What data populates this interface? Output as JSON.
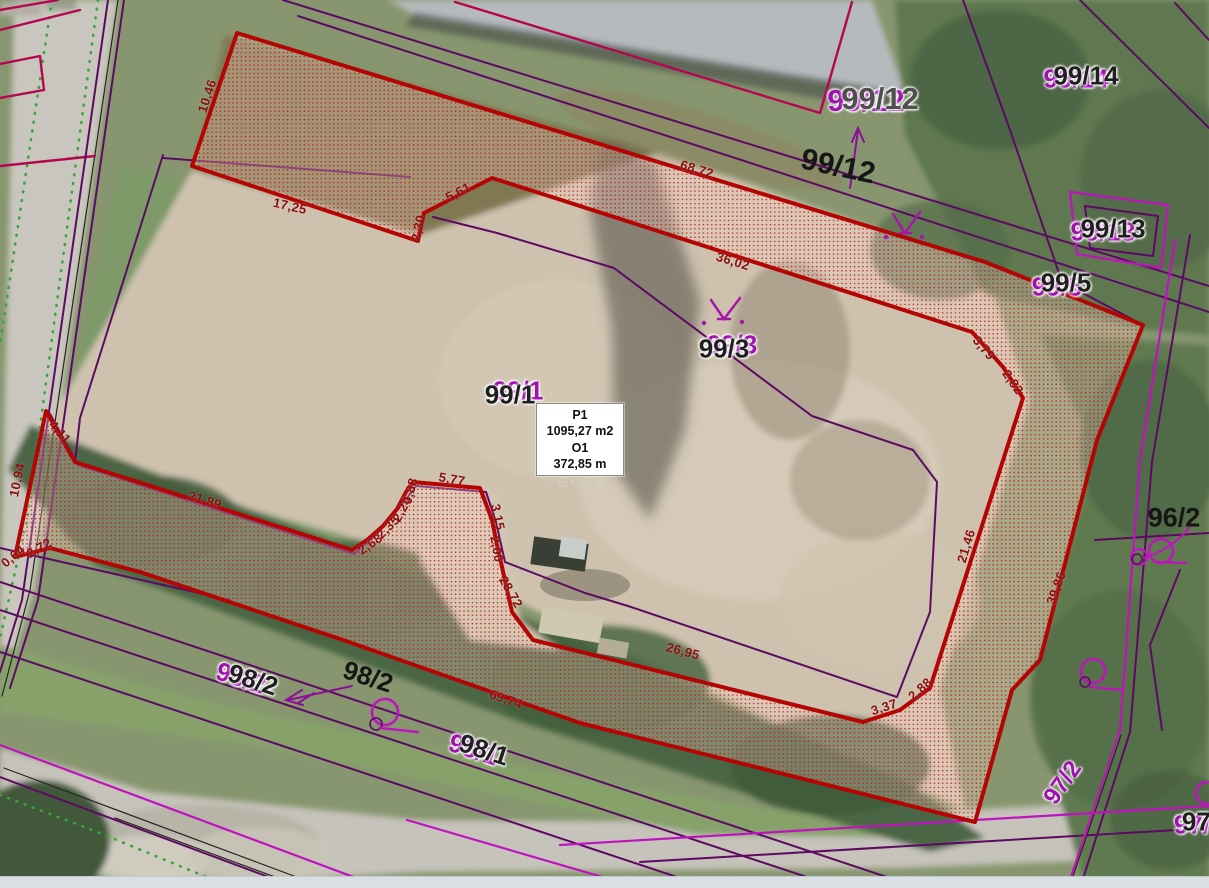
{
  "app": {
    "type": "gis-orthophoto-cadastre-measurement-view"
  },
  "measurement_box": {
    "point_label": "P1",
    "area_value": "1095,27 m2",
    "perimeter_label": "O1",
    "perimeter_value": "372,85 m"
  },
  "watermark": {
    "text": "GUZK",
    "x": 557,
    "y": 474
  },
  "colors": {
    "parcel_outline": "#b40505",
    "hatch_dot": "#cc1111",
    "cadastre_purple": "#5c0a63",
    "cadastre_magenta": "#c013c0",
    "building_line": "#b5074f",
    "dimension_text": "#8c0f0f",
    "label_black": "#1f1f1f",
    "label_purple": "#a011b0",
    "dotted_green": "#3aa43a"
  },
  "dimension_labels": [
    {
      "text": "10,46",
      "x": 207,
      "y": 96,
      "rot": -72
    },
    {
      "text": "17,25",
      "x": 290,
      "y": 206,
      "rot": 13
    },
    {
      "text": "2,30",
      "x": 418,
      "y": 228,
      "rot": -78
    },
    {
      "text": "5,61",
      "x": 458,
      "y": 192,
      "rot": -27
    },
    {
      "text": "68,72",
      "x": 697,
      "y": 169,
      "rot": 17
    },
    {
      "text": "36,02",
      "x": 733,
      "y": 261,
      "rot": 17
    },
    {
      "text": "3,79",
      "x": 984,
      "y": 348,
      "rot": 50
    },
    {
      "text": "2,82",
      "x": 1013,
      "y": 382,
      "rot": 55
    },
    {
      "text": "21,46",
      "x": 966,
      "y": 546,
      "rot": -73
    },
    {
      "text": "39,86",
      "x": 1056,
      "y": 588,
      "rot": -70
    },
    {
      "text": "26,95",
      "x": 683,
      "y": 651,
      "rot": 15
    },
    {
      "text": "3,37",
      "x": 884,
      "y": 707,
      "rot": -18
    },
    {
      "text": "2,88",
      "x": 920,
      "y": 689,
      "rot": -42
    },
    {
      "text": "69,74",
      "x": 506,
      "y": 699,
      "rot": 19
    },
    {
      "text": "21,89",
      "x": 205,
      "y": 500,
      "rot": 17
    },
    {
      "text": "2,68",
      "x": 370,
      "y": 544,
      "rot": -35
    },
    {
      "text": "2,35",
      "x": 388,
      "y": 527,
      "rot": -45
    },
    {
      "text": "2,24",
      "x": 402,
      "y": 509,
      "rot": -62
    },
    {
      "text": "0,88",
      "x": 410,
      "y": 491,
      "rot": -75
    },
    {
      "text": "5,77",
      "x": 452,
      "y": 479,
      "rot": 10
    },
    {
      "text": "3,15",
      "x": 498,
      "y": 517,
      "rot": 78
    },
    {
      "text": "2,00",
      "x": 497,
      "y": 549,
      "rot": 80
    },
    {
      "text": "28,72",
      "x": 511,
      "y": 592,
      "rot": 60
    },
    {
      "text": "4,11",
      "x": 60,
      "y": 432,
      "rot": 48
    },
    {
      "text": "10,94",
      "x": 17,
      "y": 480,
      "rot": -78
    },
    {
      "text": "0,64",
      "x": 13,
      "y": 556,
      "rot": -40
    },
    {
      "text": "2,72",
      "x": 39,
      "y": 548,
      "rot": -30
    }
  ],
  "parcel_labels": [
    {
      "text": "99/12",
      "x": 880,
      "y": 99,
      "rot": 0,
      "style": "double-gray",
      "size": 31,
      "gdx": -14,
      "gdy": 2
    },
    {
      "text": "99/12",
      "x": 838,
      "y": 167,
      "rot": 12,
      "style": "black",
      "size": 30
    },
    {
      "text": "99/14",
      "x": 1086,
      "y": 76,
      "rot": 0,
      "style": "double",
      "size": 26,
      "gdx": -10,
      "gdy": 3
    },
    {
      "text": "99/13",
      "x": 1113,
      "y": 229,
      "rot": 0,
      "style": "double",
      "size": 26,
      "gdx": -10,
      "gdy": 3
    },
    {
      "text": "99/5",
      "x": 1066,
      "y": 283,
      "rot": 0,
      "style": "double",
      "size": 26,
      "gdx": -9,
      "gdy": 4
    },
    {
      "text": "99/3",
      "x": 724,
      "y": 349,
      "rot": 0,
      "style": "double",
      "size": 26,
      "gdx": 8,
      "gdy": -4
    },
    {
      "text": "99/1",
      "x": 510,
      "y": 395,
      "rot": 0,
      "style": "double",
      "size": 26,
      "gdx": 8,
      "gdy": -4
    },
    {
      "text": "96/2",
      "x": 1174,
      "y": 518,
      "rot": 0,
      "style": "black",
      "size": 27
    },
    {
      "text": "98/2",
      "x": 253,
      "y": 680,
      "rot": 18,
      "style": "double",
      "size": 26,
      "gdx": -12,
      "gdy": 2
    },
    {
      "text": "98/2",
      "x": 368,
      "y": 677,
      "rot": 18,
      "style": "black",
      "size": 26
    },
    {
      "text": "98/1",
      "x": 484,
      "y": 750,
      "rot": 18,
      "style": "double",
      "size": 26,
      "gdx": -10,
      "gdy": 3
    },
    {
      "text": "97/2",
      "x": 1063,
      "y": 783,
      "rot": -55,
      "style": "purple-halo",
      "size": 24
    },
    {
      "text": "97/",
      "x": 1200,
      "y": 822,
      "rot": 0,
      "style": "double",
      "size": 26,
      "gdx": -8,
      "gdy": 3
    }
  ]
}
